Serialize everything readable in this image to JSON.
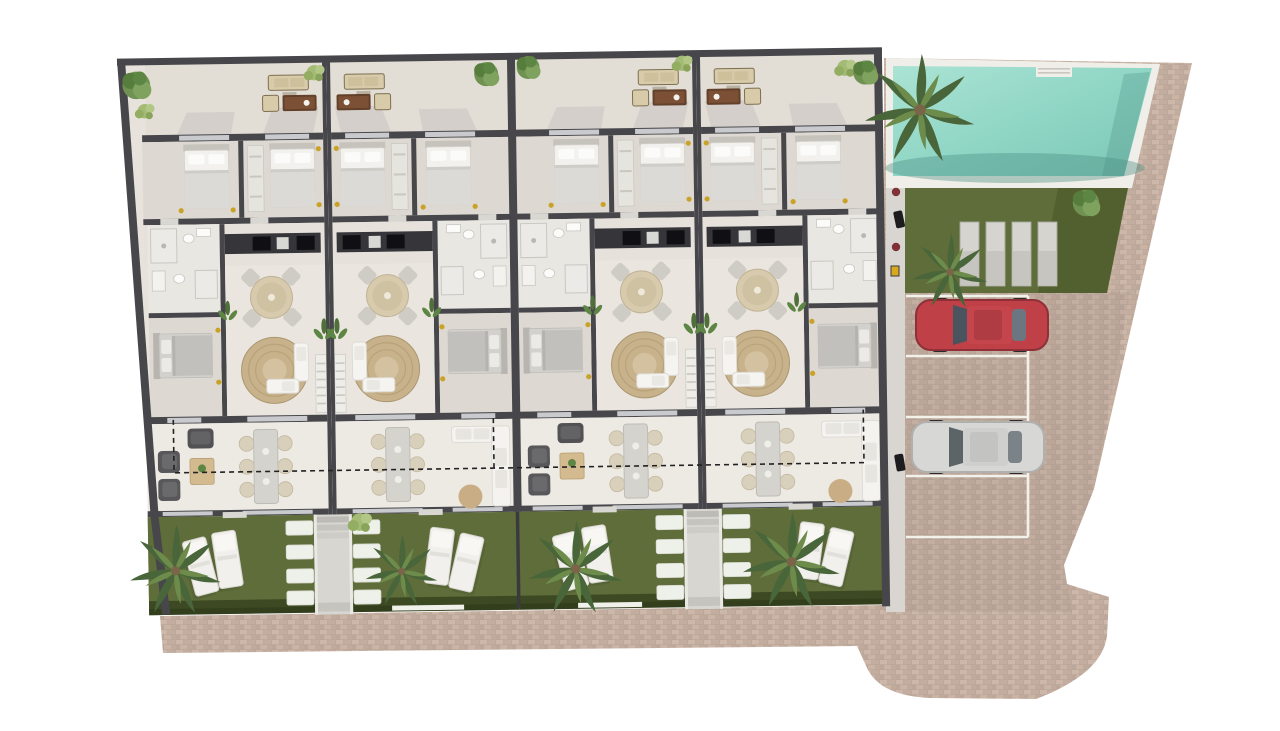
{
  "image_kind": "architectural-site-floor-plan-rendering",
  "visible_text": [],
  "colors": {
    "wall": "#47474b",
    "floor": "#e7e3dc",
    "terrace": "#e2ddd5",
    "bedfloor": "#ddd9d2",
    "livfloor": "#eae6df",
    "lowfloor": "#edeae4",
    "bathfloor": "#e9e7e2",
    "window": "#c9cacd",
    "lawn": "#5f6d3a",
    "hedge": "#3c4922",
    "deck": "#f0eee8",
    "path": "#d9d6d1",
    "walkway": "#d8d6d1",
    "kitchen": "#35353a",
    "rug": "#c8b28b",
    "sofa": "#f5f4f1",
    "gold": "#c9a227",
    "stone": "#eef0ea",
    "lounger": "#f1f0ec",
    "carRed": "#bf4046",
    "carSilver": "#d7d7d5",
    "parkingLine": "#f2f1ea",
    "poolWater": "#8ed5c4",
    "poolWaterLight": "#a9e2d3",
    "poolWaterDark": "#4c8f84",
    "paving": "#c0aca0"
  },
  "building": {
    "units": [
      {
        "id": "unit-1",
        "position": "left-end",
        "mirrored": true,
        "lounge_variant": "armchairs-coffee-table",
        "rooms": [
          "terrace",
          "bedroom",
          "bedroom",
          "bathroom",
          "kitchen",
          "living-dining",
          "bathroom",
          "bedroom",
          "family-room",
          "garden"
        ],
        "garden": {
          "palm": true,
          "sun_loungers": 2,
          "stepping_stones": 4
        }
      },
      {
        "id": "unit-2",
        "position": "mid",
        "mirrored": false,
        "lounge_variant": "corner-sofa-pouf",
        "rooms": [
          "terrace",
          "bedroom",
          "bedroom",
          "bathroom",
          "kitchen",
          "living-dining",
          "bathroom",
          "bedroom",
          "family-room",
          "garden"
        ],
        "garden": {
          "palm": true,
          "sun_loungers": 2,
          "stepping_stones": 4
        }
      },
      {
        "id": "unit-3",
        "position": "mid",
        "mirrored": true,
        "lounge_variant": "armchairs-coffee-table",
        "rooms": [
          "terrace",
          "bedroom",
          "bedroom",
          "bathroom",
          "kitchen",
          "living-dining",
          "bathroom",
          "bedroom",
          "family-room",
          "garden"
        ],
        "garden": {
          "palm": true,
          "sun_loungers": 2,
          "stepping_stones": 4
        }
      },
      {
        "id": "unit-4",
        "position": "right-end",
        "mirrored": false,
        "lounge_variant": "corner-sofa-pouf",
        "rooms": [
          "terrace",
          "bedroom",
          "bedroom",
          "bathroom",
          "kitchen",
          "living-dining",
          "bathroom",
          "bedroom",
          "family-room",
          "garden"
        ],
        "garden": {
          "palm": true,
          "sun_loungers": 2,
          "stepping_stones": 4
        }
      }
    ],
    "walkways_between_gardens": 2,
    "dashed_projection_line": true
  },
  "amenities": {
    "pool": {
      "present": true,
      "steps": 1,
      "palms": 2
    },
    "pool_lawn": {
      "concrete_pads": 4,
      "bushes": 1
    },
    "parking": {
      "bays": 4,
      "occupied_bays": [
        1,
        3
      ],
      "cars": [
        {
          "color_name": "red"
        },
        {
          "color_name": "silver"
        }
      ]
    },
    "side_path_objects": [
      "planter-pot",
      "scooter",
      "planter-pot",
      "utility-box",
      "scooter"
    ]
  },
  "landscape": {
    "terrace_trees": 3,
    "terrace_bushes": 4,
    "garden_palms": 4,
    "indoor_plants": 8
  },
  "paving": {
    "style": "brick-pavers",
    "sidewalk": true,
    "irregular_right_apron": true
  }
}
